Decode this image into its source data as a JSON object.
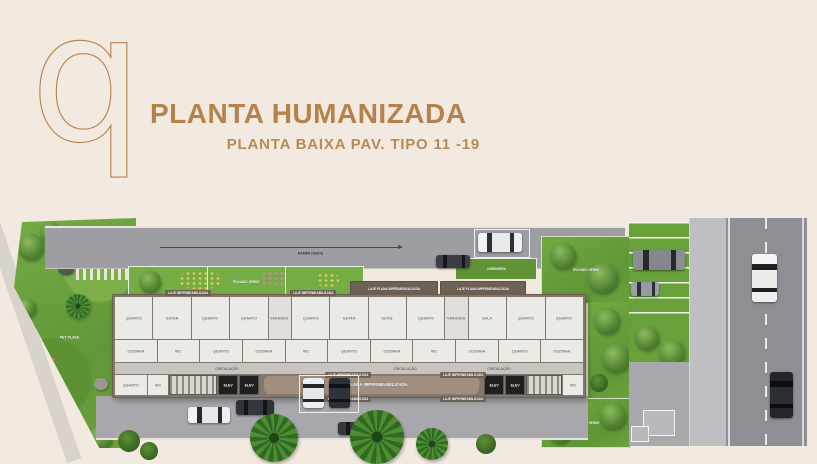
{
  "palette": {
    "background": "#f2e9e0",
    "accent": "#b5824b",
    "grass": "#6da23c",
    "road": "#8e8e94",
    "building_wall": "#84776a"
  },
  "header": {
    "logo_letter": "q",
    "title": "PLANTA HUMANIZADA",
    "subtitle": "PLANTA BAIXA PAV. TIPO 11 -19"
  },
  "plan": {
    "labels": {
      "praca": "PRAÇA",
      "pet_place": "PET PLACE",
      "telhado_verde": "TELHADO VERDE",
      "rampa_desce": "RAMPA DESCE",
      "jardineira": "JARDINEIRA",
      "laje_plana": "LAJE PLANA IMPERMEABILIZADA",
      "laje": "LAJE IMPERMEABILIZADA",
      "circulacao": "CIRCULAÇÃO",
      "elev": "ELEV"
    },
    "rooms_top": [
      "QUARTO",
      "ESTAR",
      "QUARTO",
      "QUARTO",
      "VARANDA",
      "QUARTO",
      "ESTAR",
      "SUITE",
      "QUARTO",
      "VARANDA",
      "SALA",
      "QUARTO",
      "QUARTO"
    ],
    "rooms_mid": [
      "COZINHA",
      "WC",
      "QUARTO",
      "COZINHA",
      "WC",
      "QUARTO",
      "COZINHA",
      "WC",
      "COZINHA",
      "QUARTO",
      "COZINHA"
    ],
    "rooms_bottom": [
      "QUARTO",
      "WC",
      "WC"
    ]
  }
}
